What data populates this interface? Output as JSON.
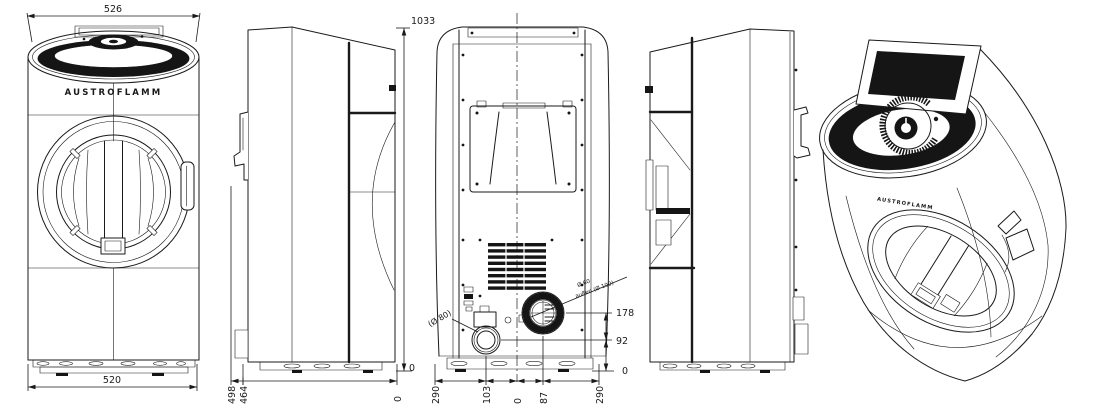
{
  "page": {
    "background": "#ffffff",
    "ink": "#1a1a1a"
  },
  "brand": {
    "front_label": "AUSTROFLAMM",
    "perspective_label": "AUSTROFLAMM"
  },
  "dimensions": {
    "front": {
      "top_width": "526",
      "bottom_width": "520"
    },
    "side": {
      "overall_height": "1033",
      "height_zero": "0",
      "depth_overall": "498",
      "depth_body": "464",
      "depth_zero": "0"
    },
    "rear": {
      "flue_center_height": "178",
      "air_center_height": "92",
      "height_zero": "0",
      "bottom_offsets": [
        "290",
        "103",
        "0",
        "87",
        "290"
      ],
      "flue_label_line1": "Ø 60",
      "flue_label_line2": "außen (Ø 100)",
      "air_label": "(Ø 80)"
    }
  }
}
